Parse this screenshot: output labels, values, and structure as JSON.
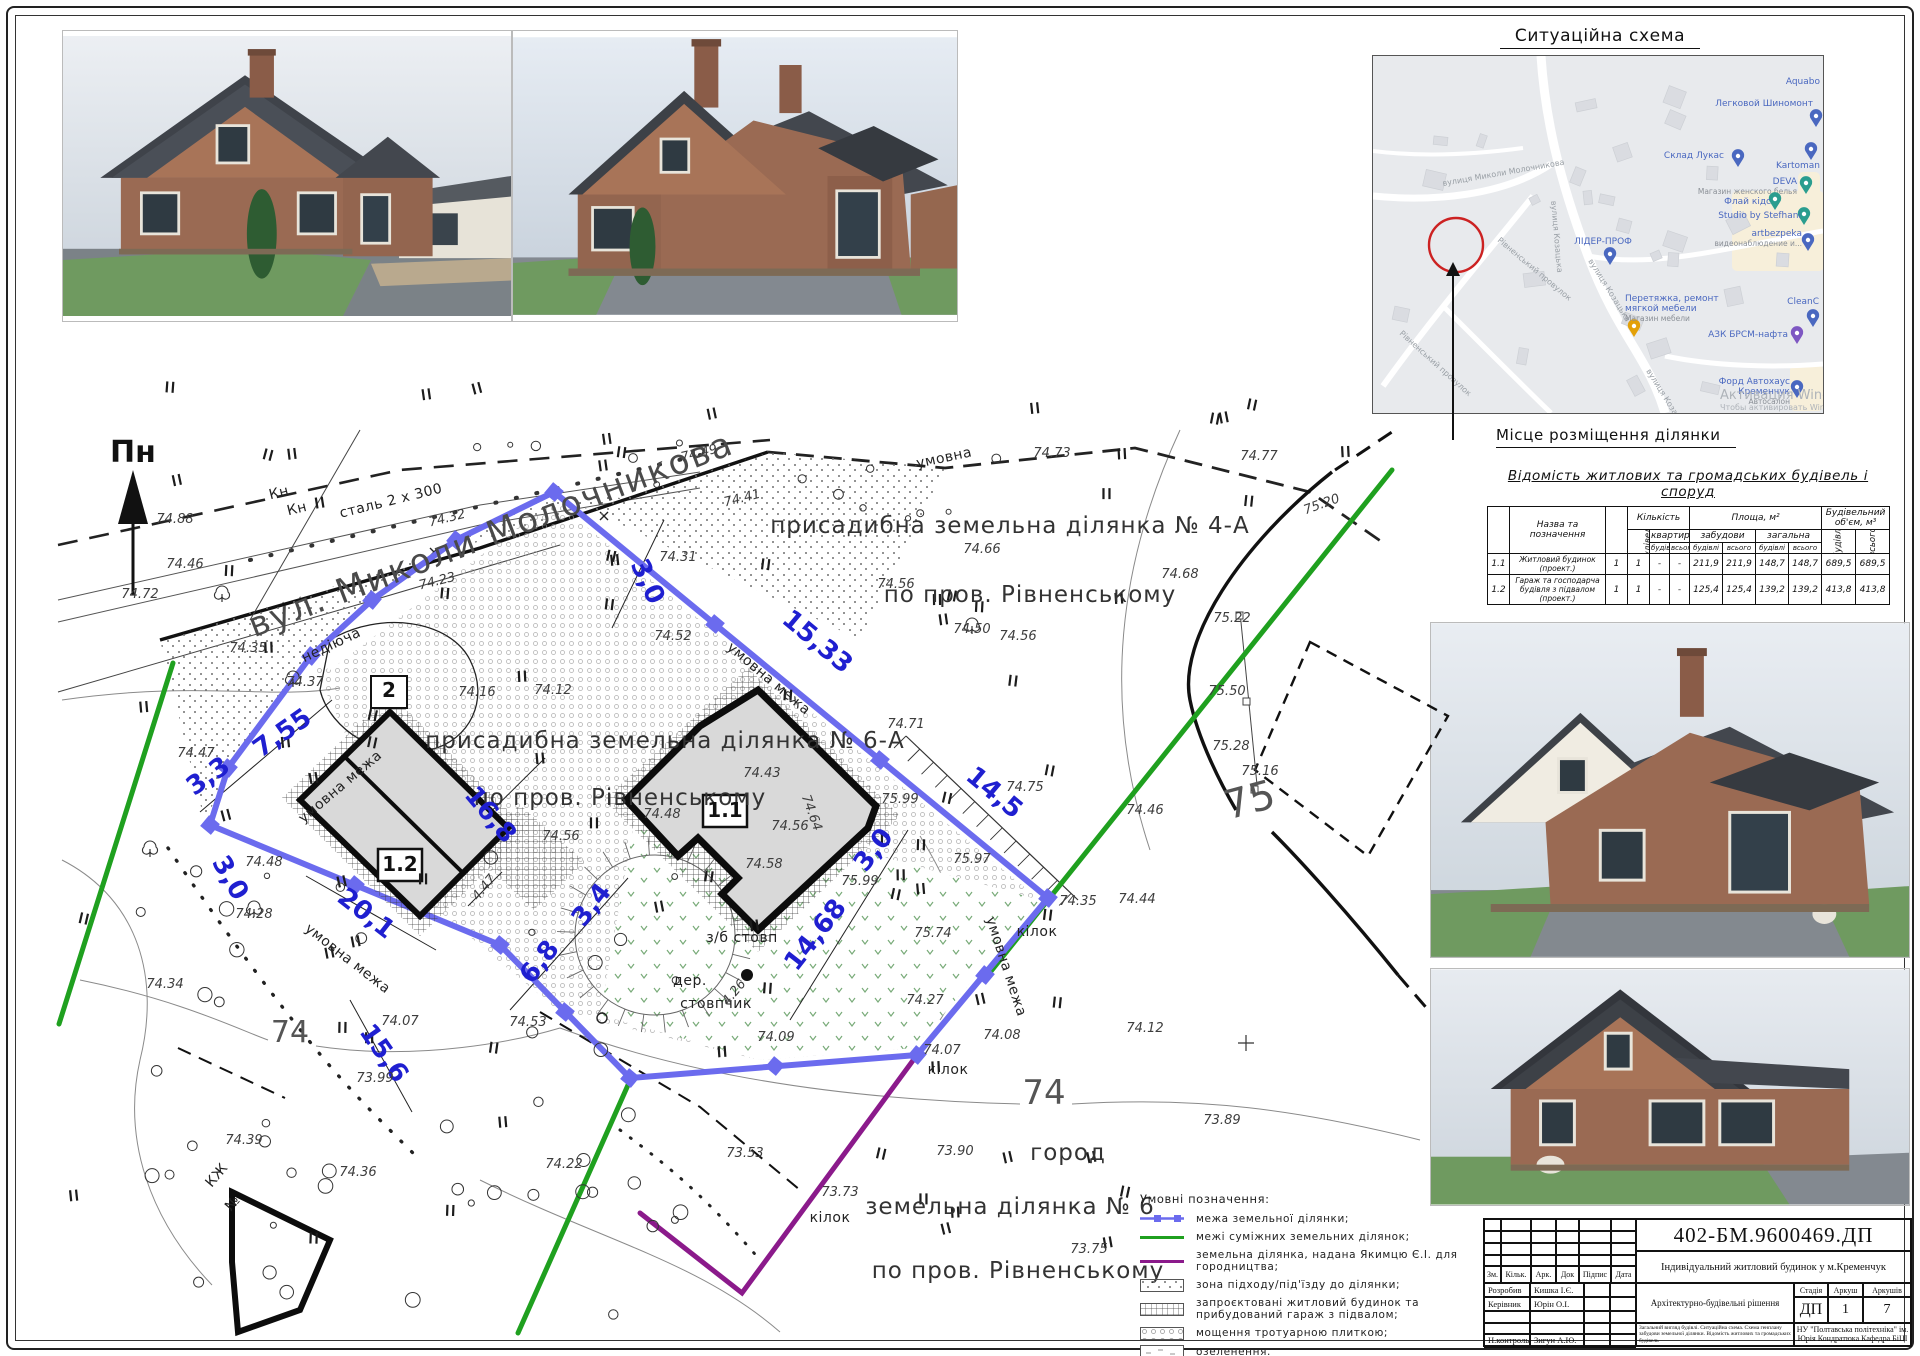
{
  "sheet": {
    "code": "402-БМ.9600469.ДП",
    "project_title": "Індивідуальний житловий будинок у м.Кременчук",
    "section_title": "Архітектурно-будівельні рішення",
    "stage_label": "Стадія",
    "stage": "ДП",
    "sheet_label": "Аркуш",
    "sheet_no": "1",
    "sheets_label": "Аркушів",
    "sheets_total": "7",
    "organization": "НУ \"Полтавська політехніка\" ім. Юрія Кондратюка Кафедра БіЦІ",
    "contents_note": "Загальний вигляд будівлі. Ситуаційна схема. Схема генплану забудови земельної ділянки. Відомість житлових та громадських будівель",
    "header_cols": [
      "Зм.",
      "Кільк.",
      "Арк.",
      "Док",
      "Підпис",
      "Дата"
    ],
    "signature_rows": [
      {
        "role": "Розробив",
        "name": "Кишка І.Є."
      },
      {
        "role": "Керівник",
        "name": "Юрін О.І."
      },
      {
        "role": "",
        "name": ""
      },
      {
        "role": "",
        "name": ""
      },
      {
        "role": "Н.контроль",
        "name": "Зигун А.Ю."
      },
      {
        "role": "Зав.кафедри",
        "name": "Семко О.В."
      }
    ]
  },
  "situation": {
    "title": "Ситуаційна схема",
    "caption": "Місце розміщення ділянки",
    "watermark_line1": "Активация Windows",
    "watermark_line2": "Чтобы активировать Windows...",
    "streets": [
      {
        "t": "вулиця Козацька",
        "x": 178,
        "y": 145,
        "rot": 85
      },
      {
        "t": "вулиця Козацька",
        "x": 215,
        "y": 205,
        "rot": 58
      },
      {
        "t": "вулиця Козацька",
        "x": 273,
        "y": 315,
        "rot": 58
      },
      {
        "t": "вулиця Миколи Молочникова",
        "x": 70,
        "y": 130,
        "rot": -10
      },
      {
        "t": "Рівненський провулок",
        "x": 124,
        "y": 185,
        "rot": 40
      },
      {
        "t": "Рівненський провулок",
        "x": 26,
        "y": 278,
        "rot": 42
      }
    ],
    "pois": [
      {
        "t": "Aquabo",
        "x": 447,
        "y": 28,
        "anchor": "end",
        "pin": null,
        "sub": null
      },
      {
        "t": "Легковой Шиномонт",
        "x": 440,
        "y": 50,
        "anchor": "end",
        "pin": [
          443,
          62,
          "#4a68c0"
        ],
        "sub": null
      },
      {
        "t": "Склад Лукас",
        "x": 351,
        "y": 102,
        "anchor": "end",
        "pin": [
          365,
          102,
          "#4a68c0"
        ],
        "sub": null
      },
      {
        "t": "Kartoman",
        "x": 447,
        "y": 112,
        "anchor": "end",
        "pin": [
          438,
          95,
          "#4a68c0"
        ],
        "sub": null
      },
      {
        "t": "DEVA",
        "x": 424,
        "y": 128,
        "anchor": "end",
        "pin": [
          433,
          129,
          "#2a9d8f"
        ],
        "sub": "Магазин женского белья"
      },
      {
        "t": "Флай кідс",
        "x": 398,
        "y": 148,
        "anchor": "end",
        "pin": [
          402,
          145,
          "#2a9d8f"
        ],
        "sub": null
      },
      {
        "t": "Studio by Stefhani",
        "x": 428,
        "y": 162,
        "anchor": "end",
        "pin": [
          431,
          160,
          "#2a9d8f"
        ],
        "sub": null
      },
      {
        "t": "artbezpeka",
        "x": 429,
        "y": 180,
        "anchor": "end",
        "pin": [
          435,
          186,
          "#4a68c0"
        ],
        "sub": "видеонаблюдение и..."
      },
      {
        "t": "ЛІДЕР-ПРОФ",
        "x": 230,
        "y": 188,
        "anchor": "middle",
        "pin": [
          237,
          200,
          "#4a68c0"
        ],
        "sub": null
      },
      {
        "t": "Перетяжка, ремонт",
        "x": 252,
        "y": 245,
        "anchor": "start",
        "pin": [
          261,
          272,
          "#e3a008"
        ],
        "sub2": "мягкой мебели",
        "sub": "Магазин мебели"
      },
      {
        "t": "CleanC",
        "x": 446,
        "y": 248,
        "anchor": "end",
        "pin": [
          440,
          262,
          "#4a68c0"
        ],
        "sub": null
      },
      {
        "t": "АЗК БРСМ-нафта",
        "x": 415,
        "y": 281,
        "anchor": "end",
        "pin": [
          424,
          279,
          "#7e57c2"
        ],
        "sub": null
      },
      {
        "t": "Форд Автохаус",
        "x": 417,
        "y": 328,
        "anchor": "end",
        "pin": [
          424,
          333,
          "#4a68c0"
        ],
        "sub2": "Кременчук",
        "sub": "Автосалон"
      }
    ]
  },
  "buildings_table": {
    "title": "Відомість житлових та громадських будівель і споруд",
    "h_num": "Номер на плані",
    "h_name": "Назва та позначення",
    "h_floors": "Поверховість",
    "h_qty": "Кількість",
    "h_qty_bld": "будівель",
    "h_flats": "квартир",
    "h_area": "Площа, м²",
    "h_zab": "забудови",
    "h_zag": "загальна",
    "h_vol": "Будівельний об'єм, м³",
    "h_bud": "будівлі",
    "h_vs": "всього",
    "rows": [
      [
        "1.1",
        "Житловий будинок (проект.)",
        "1",
        "1",
        "-",
        "-",
        "211,9",
        "211,9",
        "148,7",
        "148,7",
        "689,5",
        "689,5"
      ],
      [
        "1.2",
        "Гараж та господарча будівля з підвалом (проект.)",
        "1",
        "1",
        "-",
        "-",
        "125,4",
        "125,4",
        "139,2",
        "139,2",
        "413,8",
        "413,8"
      ]
    ]
  },
  "legend": {
    "title": "Умовні позначення:",
    "items": [
      {
        "sym": "blue",
        "label": "межа земельної ділянки;"
      },
      {
        "sym": "green",
        "label": "межі суміжних земель­них ділянок;"
      },
      {
        "sym": "purple",
        "label": "земельна ділянка, надана Якимцю Є.І. для городництва;"
      },
      {
        "sym": "stip",
        "label": "зона підходу/під'їзду до ділянки;"
      },
      {
        "sym": "grid",
        "label": "запроєктовані житловий будинок та прибудований гараж з підвалом;"
      },
      {
        "sym": "pav",
        "label": "мощення тротуарною плиткою;"
      },
      {
        "sym": "greenery",
        "label": "озеленення."
      }
    ]
  },
  "plan": {
    "north": "Пн",
    "labels": [
      [
        "вул. Миколи Молочникова",
        495,
        545,
        -21,
        "t-street"
      ],
      [
        "присадибна земельна ділянка № 4-А",
        1010,
        533,
        0,
        "t-area"
      ],
      [
        "по пров. Рівненському",
        1030,
        602,
        0,
        "t-area"
      ],
      [
        "присадибна земельна ділянка № 6-А",
        665,
        748,
        0,
        "t-area"
      ],
      [
        "по пров. Рівненському",
        620,
        805,
        0,
        "t-area"
      ],
      [
        "земельна ділянка № 6",
        1010,
        1214,
        0,
        "t-area"
      ],
      [
        "по пров. Рівненському",
        1018,
        1278,
        0,
        "t-area"
      ],
      [
        "город",
        1068,
        1160,
        0,
        "t-area"
      ],
      [
        "сталь 2 x 300",
        392,
        505,
        -14,
        "t-blk"
      ],
      [
        "Кн",
        280,
        497,
        -14,
        "t-blk"
      ],
      [
        "Кн",
        298,
        513,
        -14,
        "t-blk"
      ],
      [
        "недіюча",
        333,
        649,
        -25,
        "t-blk"
      ],
      [
        "умовна",
        945,
        462,
        -12,
        "t-blk"
      ],
      [
        "умовна межа",
        766,
        682,
        40,
        "t-blk"
      ],
      [
        "умовна межа",
        343,
        790,
        -40,
        "t-blk"
      ],
      [
        "умовна межа",
        1002,
        968,
        72,
        "t-blk"
      ],
      [
        "умовна межа",
        345,
        962,
        38,
        "t-blk"
      ],
      [
        "кілок",
        1037,
        936,
        0,
        "t-blk"
      ],
      [
        "кілок",
        948,
        1074,
        0,
        "t-blk"
      ],
      [
        "кілок",
        830,
        1222,
        0,
        "t-blk"
      ],
      [
        "з/б стовп",
        742,
        942,
        0,
        "t-blk"
      ],
      [
        "дер.",
        690,
        985,
        0,
        "t-blk"
      ],
      [
        "стовпчик",
        716,
        1008,
        0,
        "t-blk"
      ],
      [
        "КЖ",
        220,
        1178,
        -50,
        "t-blk"
      ],
      [
        "№",
        236,
        1206,
        -50,
        "t-blk"
      ],
      [
        "4.47",
        487,
        890,
        -50,
        "t-elev"
      ],
      [
        "4.26",
        737,
        995,
        -50,
        "t-elev"
      ],
      [
        "3,0",
        640,
        585,
        65,
        "t-blue"
      ],
      [
        "15,33",
        812,
        648,
        40,
        "t-blue"
      ],
      [
        "14,5",
        989,
        799,
        40,
        "t-blue"
      ],
      [
        "3,0",
        880,
        855,
        -52,
        "t-blue"
      ],
      [
        "14,68",
        822,
        940,
        -52,
        "t-blue"
      ],
      [
        "16,8",
        484,
        820,
        50,
        "t-blue"
      ],
      [
        "6,8",
        546,
        967,
        -52,
        "t-blue"
      ],
      [
        "3,4",
        598,
        910,
        -52,
        "t-blue"
      ],
      [
        "7,55",
        287,
        740,
        -35,
        "t-blue"
      ],
      [
        "3,3",
        213,
        783,
        -35,
        "t-blue"
      ],
      [
        "3,0",
        223,
        882,
        60,
        "t-blue"
      ],
      [
        "20,1",
        361,
        920,
        38,
        "t-blue"
      ],
      [
        "15,6",
        377,
        1058,
        55,
        "t-blue"
      ],
      [
        "74.88",
        175,
        523,
        0,
        "t-elev"
      ],
      [
        "74.46",
        185,
        568,
        0,
        "t-elev"
      ],
      [
        "74.72",
        140,
        598,
        0,
        "t-elev"
      ],
      [
        "74.35",
        248,
        652,
        0,
        "t-elev"
      ],
      [
        "74.37",
        305,
        686,
        0,
        "t-elev"
      ],
      [
        "74.47",
        196,
        757,
        0,
        "t-elev"
      ],
      [
        "74.34",
        165,
        988,
        0,
        "t-elev"
      ],
      [
        "74.28",
        254,
        918,
        0,
        "t-elev"
      ],
      [
        "74.39",
        244,
        1144,
        0,
        "t-elev"
      ],
      [
        "74.36",
        358,
        1176,
        0,
        "t-elev"
      ],
      [
        "74.22",
        564,
        1168,
        0,
        "t-elev"
      ],
      [
        "73.99",
        375,
        1082,
        0,
        "t-elev"
      ],
      [
        "74.07",
        400,
        1025,
        0,
        "t-elev"
      ],
      [
        "74.53",
        528,
        1026,
        0,
        "t-elev"
      ],
      [
        "74.48",
        264,
        866,
        0,
        "t-elev"
      ],
      [
        "74.32",
        448,
        522,
        -14,
        "t-elev"
      ],
      [
        "74.23",
        438,
        585,
        -14,
        "t-elev"
      ],
      [
        "74.49",
        700,
        457,
        -14,
        "t-elev"
      ],
      [
        "74.41",
        743,
        502,
        -14,
        "t-elev"
      ],
      [
        "74.31",
        678,
        561,
        0,
        "t-elev"
      ],
      [
        "74.52",
        673,
        640,
        0,
        "t-elev"
      ],
      [
        "74.16",
        477,
        696,
        0,
        "t-elev"
      ],
      [
        "74.12",
        553,
        694,
        0,
        "t-elev"
      ],
      [
        "74.43",
        762,
        777,
        0,
        "t-elev"
      ],
      [
        "74.48",
        662,
        818,
        0,
        "t-elev"
      ],
      [
        "74.56",
        790,
        830,
        0,
        "t-elev"
      ],
      [
        "74.58",
        764,
        868,
        0,
        "t-elev"
      ],
      [
        "74.56",
        561,
        840,
        0,
        "t-elev"
      ],
      [
        "75.99",
        900,
        803,
        0,
        "t-elev"
      ],
      [
        "75.97",
        972,
        863,
        0,
        "t-elev"
      ],
      [
        "75.99",
        860,
        885,
        0,
        "t-elev"
      ],
      [
        "75.74",
        933,
        937,
        0,
        "t-elev"
      ],
      [
        "74.75",
        1025,
        791,
        0,
        "t-elev"
      ],
      [
        "74.71",
        906,
        728,
        0,
        "t-elev"
      ],
      [
        "74.64",
        808,
        814,
        70,
        "t-elev"
      ],
      [
        "74.35",
        1078,
        905,
        0,
        "t-elev"
      ],
      [
        "74.44",
        1137,
        903,
        0,
        "t-elev"
      ],
      [
        "74.46",
        1145,
        814,
        0,
        "t-elev"
      ],
      [
        "74.73",
        1052,
        457,
        0,
        "t-elev"
      ],
      [
        "74.77",
        1259,
        460,
        0,
        "t-elev"
      ],
      [
        "74.66",
        982,
        553,
        0,
        "t-elev"
      ],
      [
        "74.68",
        1180,
        578,
        0,
        "t-elev"
      ],
      [
        "74.50",
        972,
        633,
        0,
        "t-elev"
      ],
      [
        "74.56",
        1018,
        640,
        0,
        "t-elev"
      ],
      [
        "74.56",
        896,
        588,
        0,
        "t-elev"
      ],
      [
        "75.20",
        1323,
        508,
        -20,
        "t-elev"
      ],
      [
        "75.22",
        1232,
        622,
        0,
        "t-elev"
      ],
      [
        "75.50",
        1227,
        695,
        0,
        "t-elev"
      ],
      [
        "75.28",
        1231,
        750,
        0,
        "t-elev"
      ],
      [
        "75.16",
        1260,
        775,
        0,
        "t-elev"
      ],
      [
        "74.09",
        776,
        1041,
        0,
        "t-elev"
      ],
      [
        "74.08",
        1002,
        1039,
        0,
        "t-elev"
      ],
      [
        "74.07",
        942,
        1054,
        0,
        "t-elev"
      ],
      [
        "74.12",
        1145,
        1032,
        0,
        "t-elev"
      ],
      [
        "74.27",
        925,
        1004,
        0,
        "t-elev"
      ],
      [
        "73.90",
        955,
        1155,
        0,
        "t-elev"
      ],
      [
        "73.53",
        745,
        1157,
        0,
        "t-elev"
      ],
      [
        "73.73",
        840,
        1196,
        0,
        "t-elev"
      ],
      [
        "73.75",
        1089,
        1253,
        0,
        "t-elev"
      ],
      [
        "73.89",
        1222,
        1124,
        0,
        "t-elev"
      ],
      [
        "74",
        290,
        1042,
        0,
        "t-cont c30"
      ],
      [
        "74",
        1044,
        1104,
        0,
        "t-cont c34"
      ],
      [
        "75",
        1253,
        813,
        -15,
        "t-cont c40"
      ],
      [
        "1.1",
        725,
        817,
        0,
        "t-box"
      ],
      [
        "1.2",
        400,
        871,
        0,
        "t-box"
      ],
      [
        "2",
        389,
        697,
        0,
        "t-box"
      ]
    ]
  },
  "colors": {
    "boundary_blue": "#6b6bee",
    "adjacent_green": "#1fa01f",
    "garden_purple": "#8b1a8b",
    "dim_blue": "#1f1fd0",
    "map_bg": "#e8eaed",
    "circle_red": "#cc2222"
  }
}
